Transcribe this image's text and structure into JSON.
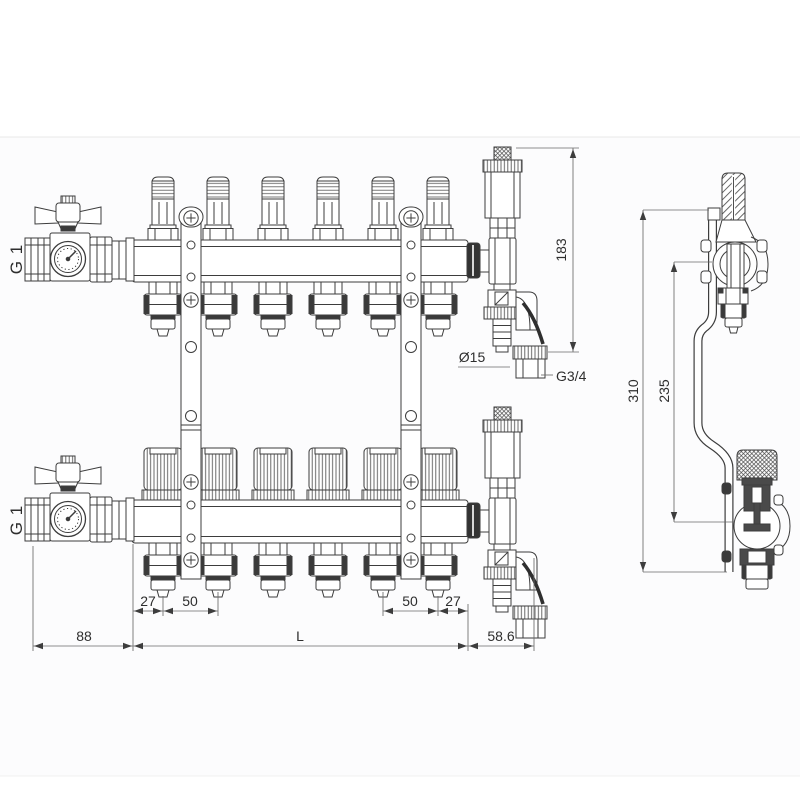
{
  "drawing": {
    "outlet_count": 6,
    "colors": {
      "line": "#3d3d3d",
      "background": "#ffffff",
      "accent_dark": "#3a3a3a"
    }
  },
  "labels": {
    "inlet_top": "G 1",
    "inlet_bottom": "G 1",
    "drain_dia": "Ø15",
    "drain_thread": "G3/4"
  },
  "dims": {
    "vent_height": "183",
    "overall_height": "310",
    "axis_distance": "235",
    "edge_left": "27",
    "pitch_left": "50",
    "pitch_right": "50",
    "edge_right": "27",
    "valve_offset": "88",
    "length": "L",
    "drain_offset": "58.6"
  }
}
